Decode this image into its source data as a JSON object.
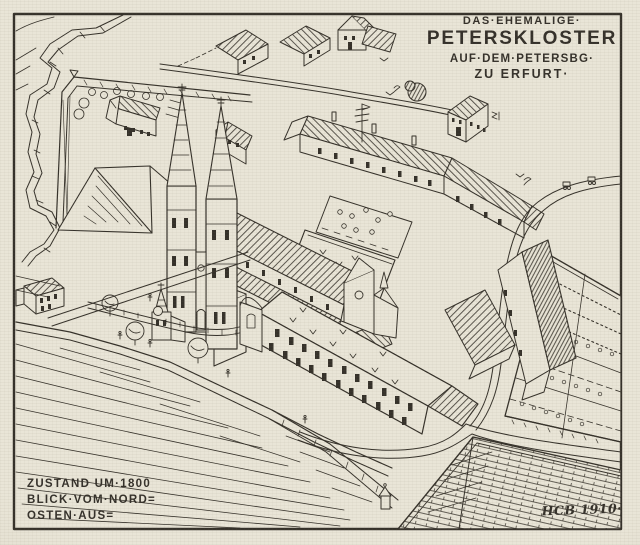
{
  "artwork": {
    "colors": {
      "paper": "#e9e5d7",
      "ink": "#35312a"
    },
    "title": {
      "line1": "DAS·EHEMALIGE·",
      "line2": "PETERSKLOSTER",
      "line3": "AUF·DEM·PETERSBG·",
      "line4": "ZU ERFURT·"
    },
    "caption": {
      "line1": "ZUSTAND UM·1800",
      "line2": "BLICK·VOM·NORD=",
      "line3": "OSTEN·AUS="
    },
    "signature": "HCB 1910·"
  }
}
